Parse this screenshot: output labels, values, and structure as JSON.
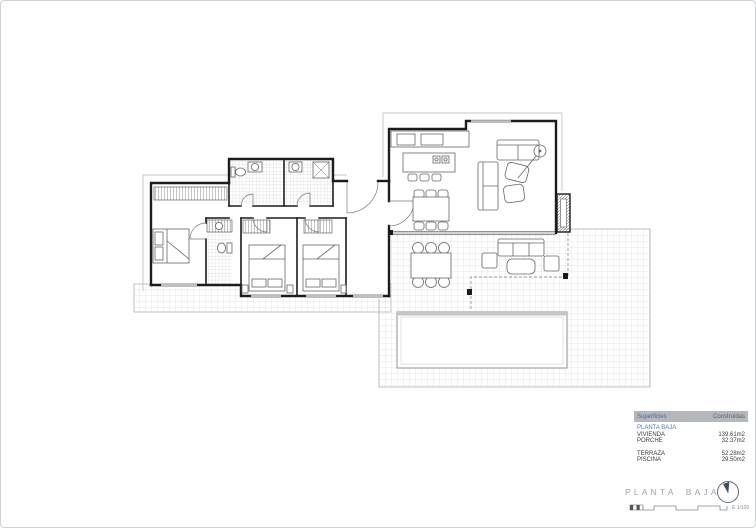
{
  "drawing": {
    "type": "floor-plan",
    "line_color": "#1c1c1c",
    "hatch_color": "#cfcfcf"
  },
  "legend": {
    "header": {
      "col1": "Superficies",
      "col2": "Construidas"
    },
    "header_bg": "#b4b8bc",
    "section": "PLANTA BAJA",
    "section_color": "#4e7ca6",
    "rows": [
      {
        "label": "VIVIENDA",
        "value": "139.61m2"
      },
      {
        "label": "PORCHE",
        "value": "32.37m2"
      },
      {
        "label": "TERRAZA",
        "value": "52.28m2"
      },
      {
        "label": "PISCINA",
        "value": "29.50m2"
      }
    ]
  },
  "titleblock": {
    "title": "PLANTA BAJA",
    "title_color": "#9aa3ad",
    "scale_label": "E 1/100",
    "compass_icon": "north-arrow-compass"
  }
}
